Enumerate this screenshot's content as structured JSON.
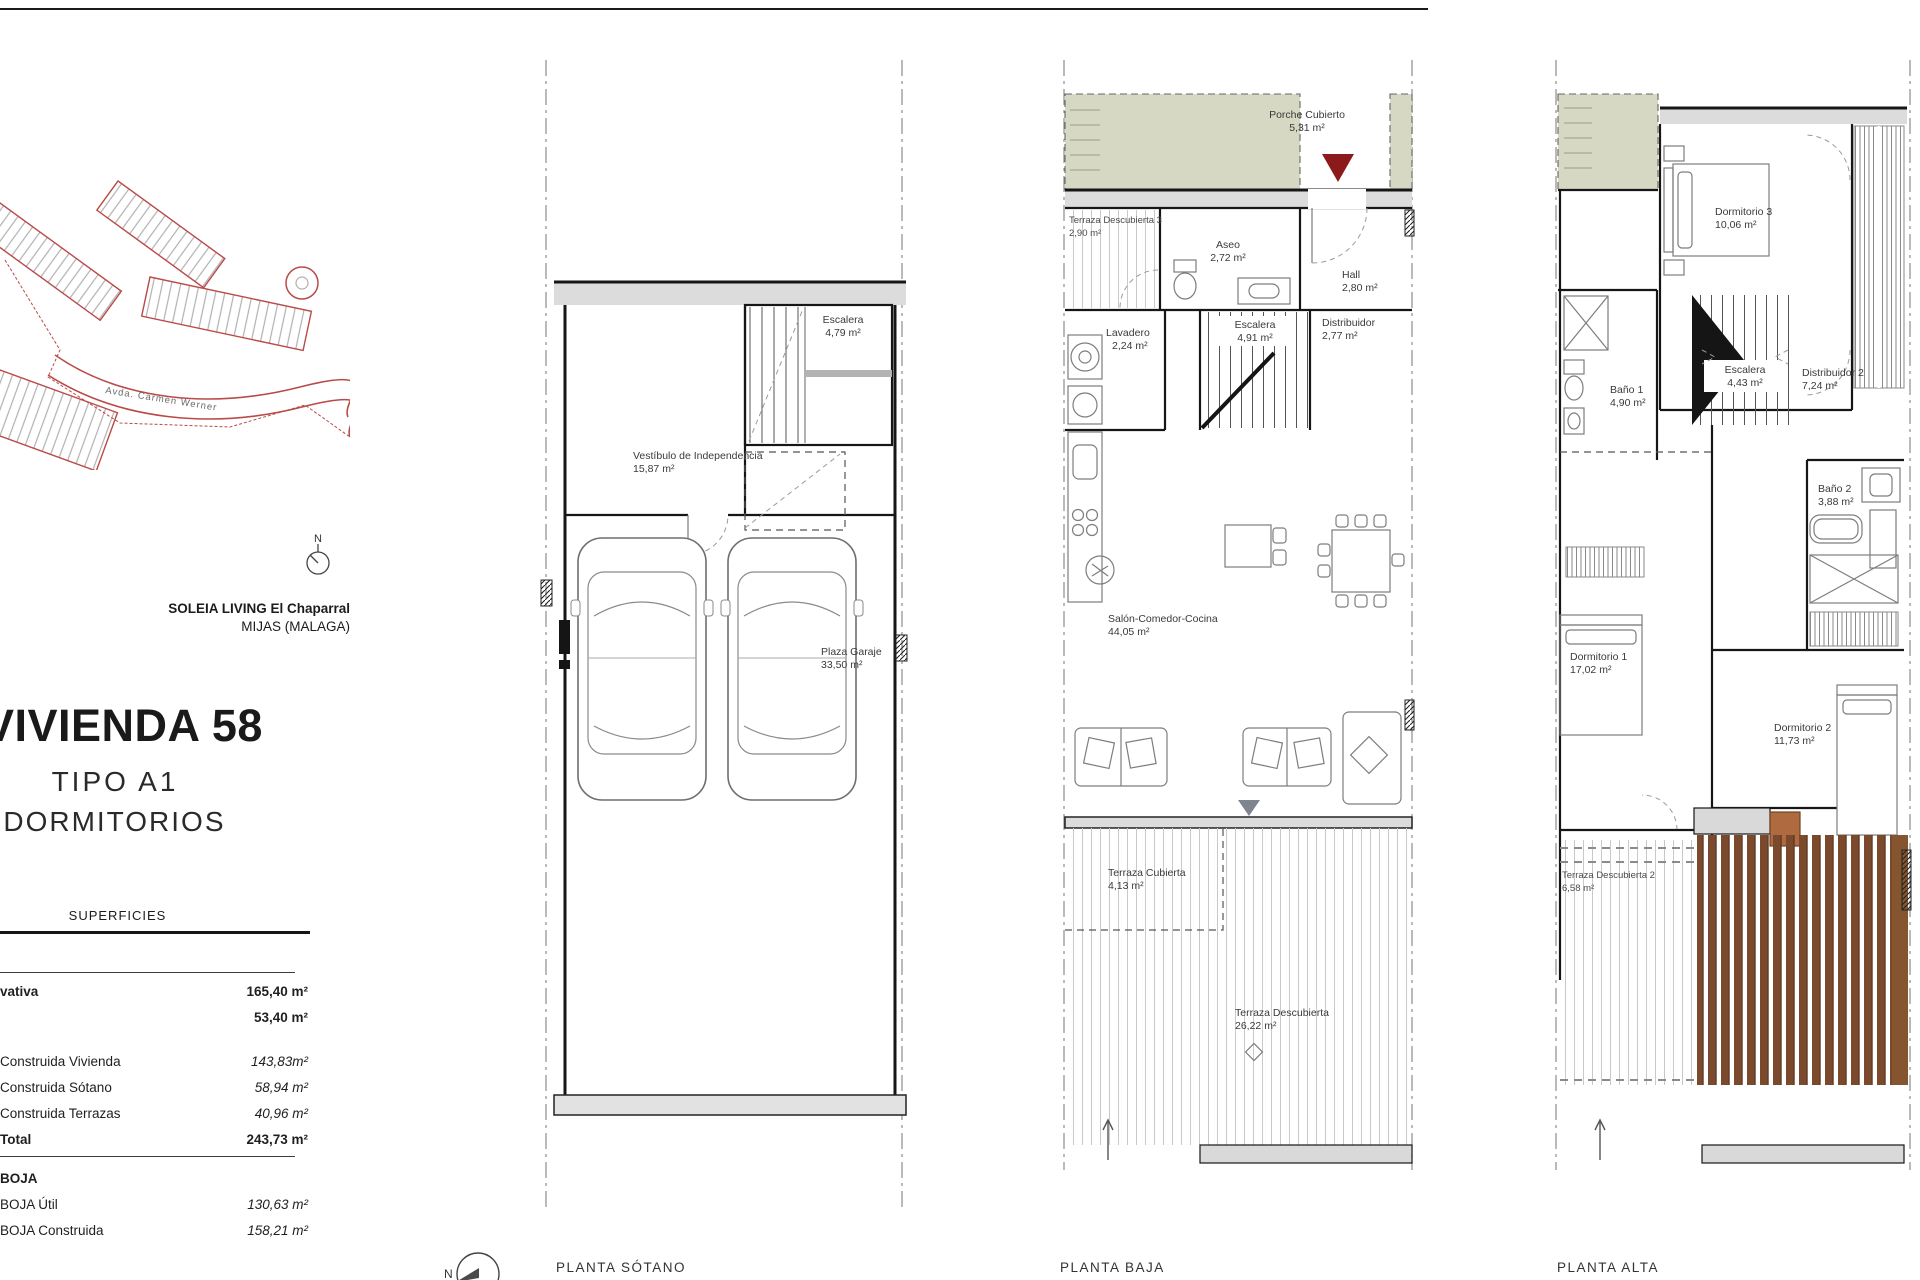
{
  "sheet": {
    "brand_line1": "SOLEIA LIVING El Chaparral",
    "brand_line2": "MIJAS (MALAGA)",
    "unit_title": "VIVIENDA 58",
    "unit_type": "TIPO A1",
    "unit_bedrooms": "3 DORMITORIOS",
    "north_label": "N"
  },
  "site_plan": {
    "street_label": "Avda. Carmen Werner"
  },
  "surfaces": {
    "header": "SUPERFICIES",
    "rows": [
      {
        "label": "vativa",
        "value": "165,40 m²"
      },
      {
        "label": "",
        "value": "53,40 m²"
      },
      {
        "label": "Construida Vivienda",
        "value": "143,83m²"
      },
      {
        "label": "Construida Sótano",
        "value": "58,94 m²"
      },
      {
        "label": "Construida Terrazas",
        "value": "40,96 m²"
      },
      {
        "label": "Total",
        "value": "243,73 m²"
      }
    ],
    "boja_header": "BOJA",
    "boja_rows": [
      {
        "label": "BOJA Útil",
        "value": "130,63 m²"
      },
      {
        "label": "BOJA Construida",
        "value": "158,21 m²"
      }
    ]
  },
  "floors": {
    "sotano": {
      "title": "PLANTA SÓTANO",
      "rooms": {
        "escalera": {
          "name": "Escalera",
          "area": "4,79 m²"
        },
        "vestibulo": {
          "name": "Vestíbulo de Independencia",
          "area": "15,87 m²"
        },
        "garaje": {
          "name": "Plaza Garaje",
          "area": "33,50 m²"
        }
      }
    },
    "baja": {
      "title": "PLANTA BAJA",
      "rooms": {
        "porche": {
          "name": "Porche Cubierto",
          "area": "5,31 m²"
        },
        "terraza3": {
          "name": "Terraza Descubierta 3",
          "area": "2,90 m²"
        },
        "aseo": {
          "name": "Aseo",
          "area": "2,72 m²"
        },
        "hall": {
          "name": "Hall",
          "area": "2,80 m²"
        },
        "lavadero": {
          "name": "Lavadero",
          "area": "2,24 m²"
        },
        "escalera": {
          "name": "Escalera",
          "area": "4,91 m²"
        },
        "distribuidor": {
          "name": "Distribuidor",
          "area": "2,77 m²"
        },
        "salon": {
          "name": "Salón-Comedor-Cocina",
          "area": "44,05 m²"
        },
        "terraza_cub": {
          "name": "Terraza Cubierta",
          "area": "4,13 m²"
        },
        "terraza_desc": {
          "name": "Terraza Descubierta",
          "area": "26,22 m²"
        }
      }
    },
    "alta": {
      "title": "PLANTA ALTA",
      "rooms": {
        "dormitorio3": {
          "name": "Dormitorio 3",
          "area": "10,06 m²"
        },
        "bano1": {
          "name": "Baño 1",
          "area": "4,90 m²"
        },
        "escalera": {
          "name": "Escalera",
          "area": "4,43 m²"
        },
        "distribuidor2": {
          "name": "Distribuidor 2",
          "area": "7,24 m²"
        },
        "bano2": {
          "name": "Baño 2",
          "area": "3,88 m²"
        },
        "dormitorio1": {
          "name": "Dormitorio 1",
          "area": "17,02 m²"
        },
        "dormitorio2": {
          "name": "Dormitorio 2",
          "area": "11,73 m²"
        },
        "terraza2": {
          "name": "Terraza Descubierta 2",
          "area": "6,58 m²"
        }
      }
    }
  },
  "colors": {
    "entry_marker_red": "#8c1a1a",
    "site_plan_red": "#b94a48",
    "porch_olive": "#d6d8c3",
    "pergola_brown": "#7b4a2d",
    "wall_fill_gray": "#dcdcdc"
  }
}
